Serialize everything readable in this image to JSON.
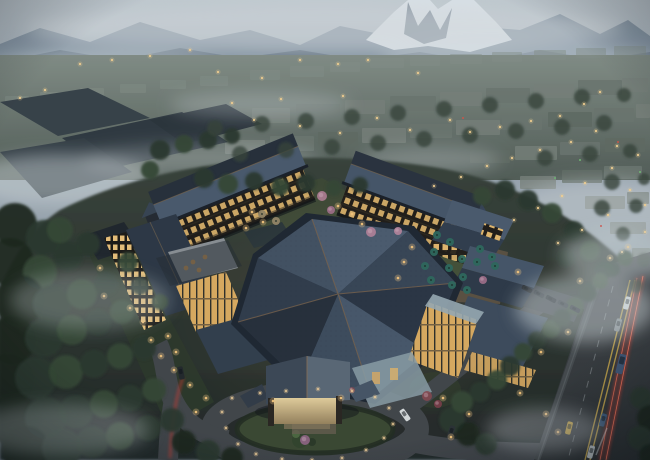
{
  "scene": {
    "description": "Dusk aerial rendering of a hotel resort complex with traditional hipped slate roofs and warm lit windows, an oval entrance lawn with a porte-cochere, courtyards with teal umbrellas, dark pine forest at left, a misty town in the valley and a snow-capped mountain range beyond, with a main road with light trails at lower right.",
    "town_lights": [
      [
        218,
        72
      ],
      [
        262,
        78
      ],
      [
        300,
        60
      ],
      [
        338,
        64
      ],
      [
        343,
        96
      ],
      [
        281,
        99
      ],
      [
        232,
        103
      ],
      [
        418,
        73
      ],
      [
        254,
        120
      ],
      [
        300,
        126
      ],
      [
        340,
        133
      ],
      [
        377,
        118
      ],
      [
        410,
        130
      ],
      [
        450,
        120
      ],
      [
        470,
        132
      ],
      [
        500,
        127
      ],
      [
        531,
        121
      ],
      [
        560,
        116
      ],
      [
        584,
        104
      ],
      [
        600,
        92
      ],
      [
        571,
        142
      ],
      [
        540,
        150
      ],
      [
        512,
        158
      ],
      [
        487,
        166
      ],
      [
        461,
        177
      ],
      [
        434,
        186
      ],
      [
        596,
        131
      ],
      [
        617,
        146
      ],
      [
        638,
        155
      ],
      [
        612,
        168
      ],
      [
        585,
        183
      ],
      [
        562,
        196
      ],
      [
        538,
        208
      ],
      [
        514,
        220
      ],
      [
        630,
        190
      ],
      [
        645,
        205
      ],
      [
        608,
        215
      ],
      [
        582,
        230
      ],
      [
        558,
        243
      ],
      [
        112,
        60
      ],
      [
        80,
        64
      ],
      [
        150,
        56
      ],
      [
        190,
        50
      ],
      [
        45,
        90
      ],
      [
        20,
        98
      ],
      [
        368,
        60
      ],
      [
        645,
        232
      ],
      [
        622,
        252
      ]
    ],
    "accent_lights": [
      [
        463,
        118,
        "#e05548"
      ],
      [
        618,
        142,
        "#e05548"
      ],
      [
        601,
        226,
        "#d84a40"
      ],
      [
        580,
        160,
        "#79c97a"
      ],
      [
        555,
        178,
        "#6fc173"
      ],
      [
        640,
        172,
        "#79c97a"
      ]
    ],
    "path_lights": [
      [
        100,
        268
      ],
      [
        104,
        296
      ],
      [
        130,
        308
      ],
      [
        143,
        322
      ],
      [
        151,
        340
      ],
      [
        161,
        356
      ],
      [
        174,
        370
      ],
      [
        190,
        385
      ],
      [
        206,
        398
      ],
      [
        168,
        336
      ],
      [
        176,
        352
      ],
      [
        196,
        412
      ],
      [
        443,
        398
      ],
      [
        451,
        437
      ],
      [
        469,
        414
      ],
      [
        520,
        393
      ],
      [
        546,
        414
      ],
      [
        558,
        432
      ],
      [
        518,
        272
      ],
      [
        580,
        281
      ],
      [
        568,
        332
      ],
      [
        541,
        352
      ],
      [
        610,
        258
      ],
      [
        628,
        247
      ],
      [
        252,
        212
      ],
      [
        263,
        222
      ],
      [
        246,
        228
      ],
      [
        352,
        214
      ],
      [
        362,
        224
      ],
      [
        338,
        206
      ],
      [
        412,
        247
      ],
      [
        404,
        262
      ],
      [
        398,
        278
      ],
      [
        273,
        401
      ],
      [
        341,
        398
      ]
    ],
    "bollard_lights": [
      [
        232,
        398
      ],
      [
        222,
        412
      ],
      [
        226,
        428
      ],
      [
        238,
        444
      ],
      [
        256,
        454
      ],
      [
        282,
        459
      ],
      [
        312,
        460
      ],
      [
        342,
        458
      ],
      [
        366,
        450
      ],
      [
        384,
        438
      ],
      [
        393,
        424
      ],
      [
        389,
        408
      ],
      [
        375,
        397
      ],
      [
        352,
        391
      ],
      [
        318,
        389
      ],
      [
        286,
        391
      ],
      [
        260,
        393
      ]
    ],
    "umbrellas": [
      [
        437,
        235,
        0
      ],
      [
        450,
        242,
        0
      ],
      [
        434,
        252,
        0
      ],
      [
        462,
        259,
        0
      ],
      [
        449,
        268,
        0
      ],
      [
        463,
        277,
        0
      ],
      [
        452,
        285,
        0
      ],
      [
        467,
        290,
        0
      ],
      [
        480,
        249,
        0
      ],
      [
        492,
        257,
        0
      ],
      [
        477,
        262,
        0
      ],
      [
        425,
        266,
        0
      ],
      [
        431,
        280,
        0
      ],
      [
        495,
        266,
        0
      ],
      [
        262,
        214,
        1
      ],
      [
        276,
        221,
        1
      ]
    ],
    "terrace_tables": [
      [
        193,
        262
      ],
      [
        205,
        257
      ],
      [
        199,
        270
      ],
      [
        186,
        268
      ]
    ],
    "blossom_shrubs": [
      [
        322,
        196,
        5,
        "#b9839b"
      ],
      [
        331,
        210,
        4,
        "#a97390"
      ],
      [
        371,
        232,
        5,
        "#bd87a0"
      ],
      [
        398,
        231,
        4,
        "#c08ba4"
      ],
      [
        483,
        280,
        4,
        "#a97390"
      ],
      [
        427,
        396,
        5,
        "#8a4a52"
      ],
      [
        438,
        404,
        4,
        "#7e3f4b"
      ],
      [
        305,
        440,
        5,
        "#96688a"
      ],
      [
        352,
        390,
        3,
        "#7d4b56"
      ]
    ],
    "town_blocks": [
      [
        5,
        96,
        24,
        9,
        3
      ],
      [
        40,
        92,
        24,
        9,
        3
      ],
      [
        80,
        88,
        24,
        9,
        3
      ],
      [
        120,
        84,
        26,
        9,
        3
      ],
      [
        160,
        80,
        26,
        9,
        3
      ],
      [
        200,
        76,
        28,
        10,
        3
      ],
      [
        250,
        70,
        30,
        10,
        3
      ],
      [
        290,
        66,
        34,
        11,
        3
      ],
      [
        330,
        62,
        30,
        10,
        3
      ],
      [
        370,
        58,
        34,
        10,
        3
      ],
      [
        410,
        56,
        30,
        10,
        3
      ],
      [
        450,
        54,
        32,
        10,
        3
      ],
      [
        492,
        52,
        30,
        10,
        3
      ],
      [
        534,
        50,
        32,
        10,
        3
      ],
      [
        576,
        48,
        30,
        10,
        3
      ],
      [
        614,
        46,
        32,
        10,
        3
      ],
      [
        205,
        112,
        42,
        16,
        0
      ],
      [
        252,
        108,
        38,
        15,
        1
      ],
      [
        296,
        104,
        44,
        16,
        0
      ],
      [
        345,
        100,
        40,
        14,
        1
      ],
      [
        390,
        96,
        46,
        15,
        0
      ],
      [
        440,
        92,
        42,
        14,
        1
      ],
      [
        486,
        88,
        44,
        15,
        0
      ],
      [
        534,
        84,
        40,
        14,
        1
      ],
      [
        578,
        80,
        44,
        15,
        0
      ],
      [
        622,
        78,
        26,
        14,
        1
      ],
      [
        225,
        140,
        40,
        14,
        1
      ],
      [
        270,
        136,
        44,
        15,
        0
      ],
      [
        318,
        132,
        40,
        14,
        2
      ],
      [
        362,
        128,
        44,
        15,
        1
      ],
      [
        410,
        124,
        42,
        14,
        0
      ],
      [
        456,
        120,
        44,
        15,
        1
      ],
      [
        502,
        116,
        40,
        14,
        0
      ],
      [
        548,
        112,
        44,
        15,
        2
      ],
      [
        594,
        108,
        40,
        14,
        0
      ],
      [
        636,
        104,
        14,
        14,
        1
      ],
      [
        470,
        150,
        40,
        13,
        2
      ],
      [
        515,
        146,
        42,
        14,
        1
      ],
      [
        560,
        142,
        40,
        13,
        0
      ],
      [
        605,
        138,
        40,
        14,
        2
      ],
      [
        520,
        176,
        36,
        13,
        1
      ],
      [
        562,
        170,
        40,
        13,
        2
      ],
      [
        604,
        166,
        38,
        13,
        0
      ],
      [
        585,
        196,
        40,
        13,
        1
      ],
      [
        627,
        192,
        22,
        12,
        2
      ],
      [
        610,
        222,
        36,
        12,
        1
      ],
      [
        632,
        248,
        18,
        12,
        1
      ],
      [
        626,
        274,
        22,
        12,
        2
      ]
    ],
    "forest_trees": [
      [
        15,
        225,
        22,
        0
      ],
      [
        44,
        238,
        18,
        1
      ],
      [
        10,
        262,
        24,
        0
      ],
      [
        40,
        272,
        17,
        2
      ],
      [
        68,
        256,
        15,
        1
      ],
      [
        60,
        230,
        13,
        2
      ],
      [
        88,
        244,
        12,
        1
      ],
      [
        20,
        300,
        25,
        0
      ],
      [
        52,
        304,
        19,
        1
      ],
      [
        82,
        294,
        15,
        2
      ],
      [
        106,
        284,
        12,
        1
      ],
      [
        12,
        340,
        24,
        0
      ],
      [
        44,
        338,
        19,
        1
      ],
      [
        72,
        330,
        15,
        2
      ],
      [
        98,
        322,
        13,
        1
      ],
      [
        122,
        312,
        12,
        2
      ],
      [
        8,
        380,
        26,
        0
      ],
      [
        36,
        378,
        21,
        1
      ],
      [
        66,
        372,
        17,
        2
      ],
      [
        94,
        364,
        14,
        1
      ],
      [
        120,
        356,
        13,
        2
      ],
      [
        144,
        348,
        12,
        1
      ],
      [
        14,
        420,
        26,
        0
      ],
      [
        46,
        418,
        21,
        1
      ],
      [
        76,
        412,
        17,
        1
      ],
      [
        104,
        404,
        14,
        2
      ],
      [
        130,
        398,
        13,
        1
      ],
      [
        154,
        390,
        12,
        2
      ],
      [
        26,
        450,
        24,
        0
      ],
      [
        62,
        448,
        20,
        1
      ],
      [
        92,
        442,
        16,
        1
      ],
      [
        120,
        436,
        14,
        2
      ],
      [
        148,
        428,
        13,
        1
      ],
      [
        172,
        420,
        12,
        1
      ],
      [
        184,
        442,
        12,
        0
      ],
      [
        208,
        452,
        12,
        1
      ],
      [
        232,
        458,
        11,
        0
      ],
      [
        128,
        262,
        10,
        2
      ],
      [
        140,
        286,
        9,
        1
      ],
      [
        160,
        302,
        8,
        2
      ],
      [
        160,
        150,
        10,
        1
      ],
      [
        184,
        144,
        9,
        2
      ],
      [
        208,
        140,
        9,
        1
      ],
      [
        150,
        170,
        9,
        2
      ],
      [
        232,
        136,
        8,
        1
      ],
      [
        204,
        178,
        10,
        1
      ],
      [
        228,
        184,
        10,
        2
      ],
      [
        254,
        181,
        9,
        1
      ],
      [
        280,
        187,
        9,
        2
      ],
      [
        306,
        183,
        9,
        1
      ],
      [
        334,
        188,
        8,
        2
      ],
      [
        360,
        185,
        8,
        1
      ],
      [
        505,
        190,
        10,
        1
      ],
      [
        482,
        196,
        9,
        2
      ],
      [
        528,
        200,
        10,
        1
      ],
      [
        552,
        213,
        10,
        2
      ],
      [
        574,
        231,
        10,
        1
      ],
      [
        590,
        251,
        10,
        2
      ],
      [
        566,
        258,
        9,
        1
      ],
      [
        604,
        270,
        9,
        1
      ],
      [
        452,
        420,
        13,
        1
      ],
      [
        468,
        434,
        12,
        0
      ],
      [
        486,
        444,
        11,
        1
      ],
      [
        462,
        402,
        11,
        2
      ],
      [
        480,
        392,
        10,
        1
      ],
      [
        497,
        380,
        10,
        2
      ],
      [
        510,
        366,
        10,
        1
      ],
      [
        523,
        352,
        9,
        2
      ],
      [
        537,
        340,
        9,
        1
      ],
      [
        551,
        329,
        9,
        2
      ],
      [
        562,
        318,
        9,
        1
      ],
      [
        575,
        306,
        9,
        2
      ],
      [
        588,
        293,
        9,
        1
      ],
      [
        600,
        281,
        8,
        2
      ],
      [
        612,
        269,
        8,
        1
      ],
      [
        625,
        258,
        8,
        2
      ],
      [
        641,
        398,
        11,
        1
      ],
      [
        650,
        418,
        13,
        0
      ],
      [
        640,
        438,
        12,
        1
      ],
      [
        650,
        455,
        11,
        0
      ],
      [
        215,
        128,
        8,
        3
      ],
      [
        262,
        124,
        8,
        3
      ],
      [
        306,
        121,
        8,
        3
      ],
      [
        352,
        117,
        8,
        3
      ],
      [
        398,
        113,
        8,
        3
      ],
      [
        444,
        109,
        8,
        3
      ],
      [
        490,
        105,
        8,
        3
      ],
      [
        536,
        101,
        8,
        3
      ],
      [
        582,
        97,
        8,
        3
      ],
      [
        624,
        95,
        7,
        3
      ],
      [
        240,
        154,
        8,
        3
      ],
      [
        286,
        150,
        8,
        3
      ],
      [
        332,
        147,
        8,
        3
      ],
      [
        378,
        143,
        8,
        3
      ],
      [
        424,
        139,
        8,
        3
      ],
      [
        470,
        135,
        8,
        3
      ],
      [
        516,
        131,
        8,
        3
      ],
      [
        562,
        127,
        8,
        3
      ],
      [
        604,
        123,
        8,
        3
      ],
      [
        545,
        158,
        8,
        3
      ],
      [
        590,
        154,
        8,
        3
      ],
      [
        630,
        151,
        7,
        3
      ],
      [
        612,
        182,
        8,
        3
      ],
      [
        644,
        179,
        6,
        3
      ],
      [
        602,
        208,
        8,
        3
      ],
      [
        636,
        206,
        7,
        3
      ],
      [
        623,
        234,
        7,
        3
      ],
      [
        644,
        260,
        7,
        3
      ],
      [
        636,
        286,
        7,
        3
      ]
    ],
    "vehicles": [
      [
        627,
        303,
        15,
        "#dde2e5"
      ],
      [
        618,
        325,
        15,
        "#848c91"
      ],
      [
        621,
        364,
        14,
        "#41597a",
        20,
        7
      ],
      [
        603,
        420,
        16,
        "#3c5a7d"
      ],
      [
        569,
        428,
        14,
        "#c9a43e"
      ],
      [
        591,
        452,
        15,
        "#b7bec2"
      ],
      [
        405,
        415,
        -35,
        "#dfe3e5"
      ],
      [
        451,
        432,
        18,
        "#2c3236"
      ],
      [
        181,
        373,
        -12,
        "#23282d"
      ]
    ],
    "parked_cars": [
      [
        527,
        289,
        -62,
        "#23282e"
      ],
      [
        539,
        294,
        -62,
        "#2b3138"
      ],
      [
        551,
        299,
        -62,
        "#1f252b"
      ],
      [
        563,
        304,
        -62,
        "#2e343b"
      ],
      [
        575,
        309,
        -62,
        "#272d34"
      ]
    ]
  },
  "palette": {
    "sky_top": "#c9d2d9",
    "sky_bottom": "#a6b2bd",
    "mountain_far": "#8494a4",
    "mountain_near": "#6b7c8c",
    "snow": "#e4ecf2",
    "valley_top": "#87928b",
    "valley_bottom": "#545f59",
    "town_tones": [
      "#6f7973",
      "#7c857e",
      "#636d66",
      "#8a948e"
    ],
    "town_opacity": [
      0.85,
      0.8,
      0.85,
      0.45
    ],
    "tree_tones": [
      "#1d2820",
      "#2a3a2e",
      "#374936",
      "#39443c"
    ],
    "roof_dark": "#2c3646",
    "roof_light": "#4e5e73",
    "ridge": "#7d6952",
    "window_warm": "#ecbf72",
    "lawn": "#3c4a33",
    "asphalt": "#43474c",
    "road_line_yellow": "#c9a84c",
    "tail_light_red": "#d23e30",
    "umbrella_colors": [
      "#2f6b60",
      "#9a8a6a"
    ],
    "light_warm": "#ffd998",
    "mist": "#dfe6ea"
  }
}
